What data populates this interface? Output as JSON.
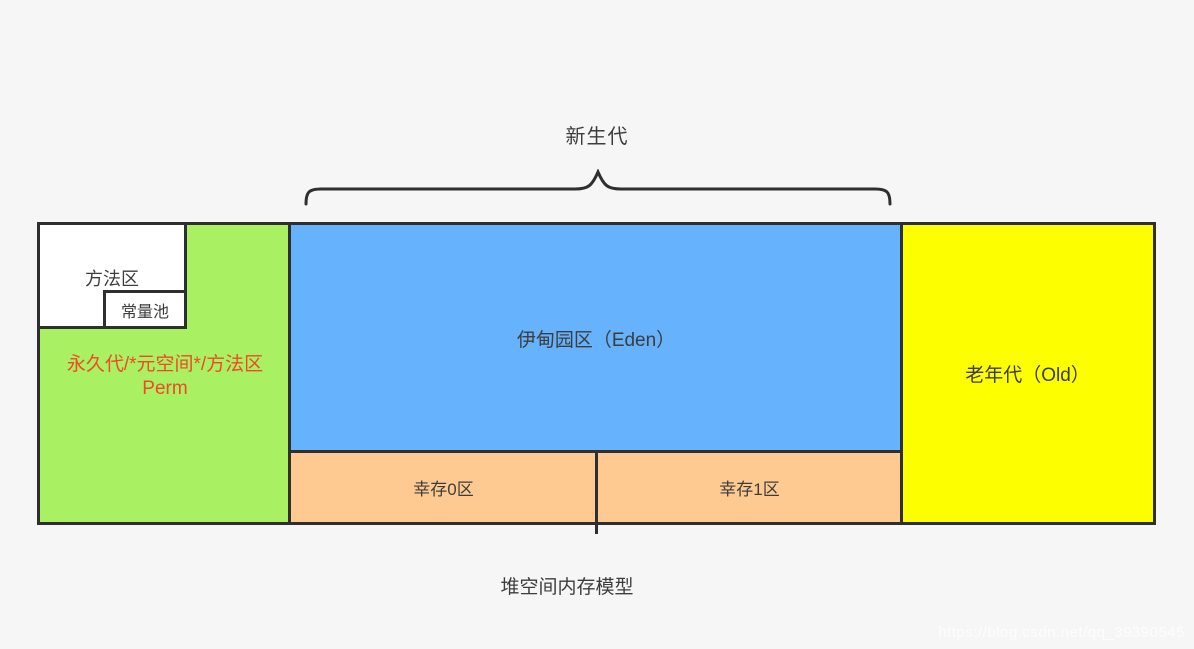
{
  "watermark": "https://blog.csdn.net/qq_39390545",
  "diagram": {
    "new_gen_label": "新生代",
    "caption": "堆空间内存模型",
    "regions": {
      "method_area": "方法区",
      "constant_pool": "常量池",
      "perm_line1": "永久代/*元空间*/方法区",
      "perm_line2": "Perm",
      "eden": "伊甸园区（Eden）",
      "survivor0": "幸存0区",
      "survivor1": "幸存1区",
      "old": "老年代（Old）"
    },
    "colors": {
      "background": "#f6f6f6",
      "perm_green": "#a9f163",
      "eden_blue": "#66b2fc",
      "survivor_orange": "#ffca92",
      "old_yellow": "#fdff00",
      "border_dark": "#2f2f2f",
      "perm_text_red": "#f04a24",
      "label_text": "#3d3d3d",
      "white": "#ffffff"
    }
  }
}
